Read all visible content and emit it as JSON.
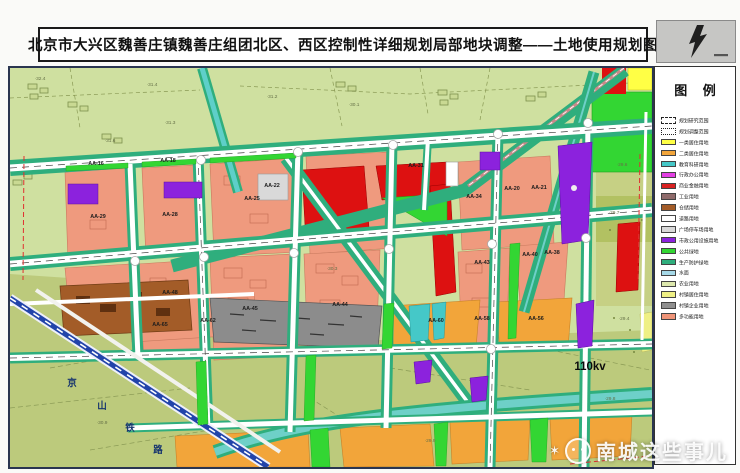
{
  "title": "北京市大兴区魏善庄镇魏善庄组团北区、西区控制性详细规划局部地块调整——土地使用规划图",
  "legend": {
    "title": "图 例",
    "items": [
      {
        "label": "规划研究范围",
        "type": "dashed"
      },
      {
        "label": "规划调整范围",
        "type": "dashdot"
      },
      {
        "label": "一类居住用地",
        "color": "#ffff45"
      },
      {
        "label": "二类居住用地",
        "color": "#f2a53a"
      },
      {
        "label": "教育科研用地",
        "color": "#45c8c8"
      },
      {
        "label": "行政办公用地",
        "color": "#e33fe3"
      },
      {
        "label": "商业金融用地",
        "color": "#d92121"
      },
      {
        "label": "工业用地",
        "color": "#8f6b6b"
      },
      {
        "label": "仓储用地",
        "color": "#a35c28"
      },
      {
        "label": "道路用地",
        "color": "#ffffff"
      },
      {
        "label": "广场停车场用地",
        "color": "#d9d9d9"
      },
      {
        "label": "市政公用设施用地",
        "color": "#8c22dd"
      },
      {
        "label": "公共绿地",
        "color": "#33d633"
      },
      {
        "label": "生产防护绿地",
        "color": "#2fae7d"
      },
      {
        "label": "水面",
        "color": "#a6d9e8"
      },
      {
        "label": "农业用地",
        "color": "#dde8ad"
      },
      {
        "label": "村镇居住用地",
        "color": "#eff085"
      },
      {
        "label": "村镇企业用地",
        "color": "#8f8f8f"
      },
      {
        "label": "多功能用地",
        "color": "#ef9478"
      }
    ]
  },
  "map": {
    "block_labels": [
      {
        "t": "AA-16",
        "x": 86,
        "y": 97
      },
      {
        "t": "AA-18",
        "x": 158,
        "y": 94
      },
      {
        "t": "AA-29",
        "x": 88,
        "y": 150
      },
      {
        "t": "AA-28",
        "x": 160,
        "y": 148
      },
      {
        "t": "AA-25",
        "x": 242,
        "y": 132
      },
      {
        "t": "AA-22",
        "x": 262,
        "y": 119
      },
      {
        "t": "AA-31",
        "x": 406,
        "y": 99
      },
      {
        "t": "AA-34",
        "x": 464,
        "y": 130
      },
      {
        "t": "AA-20",
        "x": 502,
        "y": 122
      },
      {
        "t": "AA-21",
        "x": 529,
        "y": 121
      },
      {
        "t": "AA-48",
        "x": 160,
        "y": 226
      },
      {
        "t": "AA-45",
        "x": 240,
        "y": 242
      },
      {
        "t": "AA-44",
        "x": 330,
        "y": 238
      },
      {
        "t": "AA-43",
        "x": 472,
        "y": 196
      },
      {
        "t": "AA-40",
        "x": 520,
        "y": 188
      },
      {
        "t": "AA-38",
        "x": 542,
        "y": 186
      },
      {
        "t": "AA-65",
        "x": 150,
        "y": 258
      },
      {
        "t": "AA-62",
        "x": 198,
        "y": 254
      },
      {
        "t": "AA-60",
        "x": 426,
        "y": 254
      },
      {
        "t": "AA-58",
        "x": 472,
        "y": 252
      },
      {
        "t": "AA-56",
        "x": 526,
        "y": 252
      }
    ],
    "elevations": [
      {
        "t": "32.4",
        "x": 30,
        "y": 12
      },
      {
        "t": "31.4",
        "x": 142,
        "y": 18
      },
      {
        "t": "31.2",
        "x": 262,
        "y": 30
      },
      {
        "t": "31.3",
        "x": 160,
        "y": 56
      },
      {
        "t": "30.1",
        "x": 344,
        "y": 38
      },
      {
        "t": "31.6",
        "x": 100,
        "y": 74
      },
      {
        "t": "29.6",
        "x": 612,
        "y": 98
      },
      {
        "t": "29.7",
        "x": 604,
        "y": 146
      },
      {
        "t": "29.4",
        "x": 614,
        "y": 252
      },
      {
        "t": "29.8",
        "x": 600,
        "y": 332
      },
      {
        "t": "30.3",
        "x": 322,
        "y": 202
      },
      {
        "t": "30.9",
        "x": 92,
        "y": 356
      },
      {
        "t": "29.9",
        "x": 420,
        "y": 374
      }
    ],
    "railway_name": "京山铁路",
    "railway_char_pos": [
      [
        62,
        318
      ],
      [
        92,
        341
      ],
      [
        120,
        363
      ],
      [
        148,
        385
      ]
    ],
    "power_label": {
      "t": "110kv",
      "x": 580,
      "y": 302
    }
  },
  "watermark": "南城这些事儿"
}
